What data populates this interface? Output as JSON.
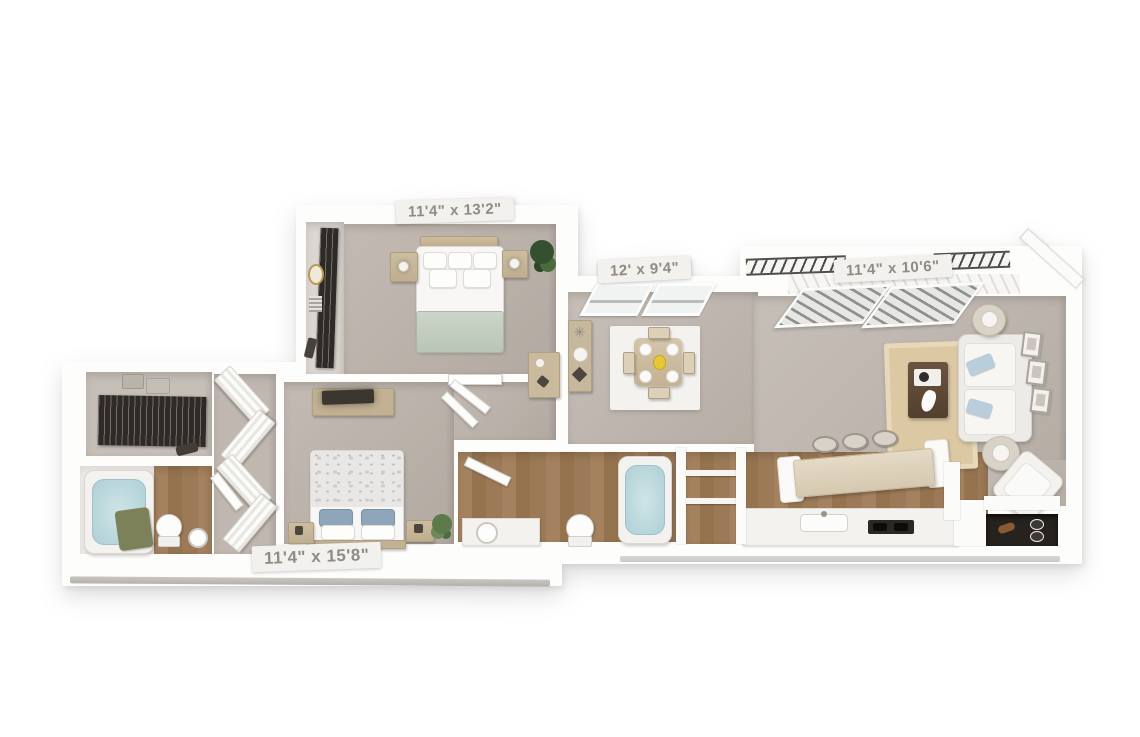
{
  "floorplan": {
    "title": "3D apartment floor plan",
    "style": "top-down 3D render, white walls on white background",
    "labels": {
      "bedroom_top": "11'4\" x 13'2\"",
      "dining": "12' x 9'4\"",
      "living": "11'4\" x 10'6\"",
      "bedroom_bottom": "11'4\" x 15'8\""
    },
    "rooms": [
      {
        "id": "bedroom-top",
        "dimensions": "11'4\" x 13'2\"",
        "floor": "gray carpet",
        "furniture": [
          "queen-bed-sage-throw",
          "headboard-shelf",
          "nightstand-left",
          "nightstand-right",
          "table-lamps",
          "wardrobe-hanging-clothes",
          "mirror",
          "corner-plant",
          "door"
        ]
      },
      {
        "id": "dining-room",
        "dimensions": "12' x 9'4\"",
        "floor": "gray carpet",
        "furniture": [
          "dining-table",
          "four-chairs",
          "place-settings",
          "yellow-centerpiece",
          "white-area-rug",
          "console-table",
          "two-windows"
        ]
      },
      {
        "id": "living-room",
        "dimensions": "11'4\" x 10'6\"",
        "floor": "gray carpet",
        "furniture": [
          "sofa-with-blue-pillows",
          "coffee-table",
          "tan-area-rug",
          "round-side-table-top",
          "round-side-table-bottom",
          "lamps",
          "three-wall-frames",
          "accent-chair",
          "balcony-railing",
          "sliding-door-blinds"
        ]
      },
      {
        "id": "bedroom-bottom",
        "dimensions": "11'4\" x 15'8\"",
        "floor": "gray carpet",
        "furniture": [
          "queen-bed-floral-duvet",
          "blue-pillows",
          "dresser-with-tv",
          "nightstand-left",
          "nightstand-right",
          "plant",
          "louvered-closet-doors"
        ]
      },
      {
        "id": "walk-in-closet",
        "floor": "gray",
        "furniture": [
          "hanging-clothes-rail",
          "storage-boxes",
          "clutch-bag"
        ]
      },
      {
        "id": "ensuite-bathroom",
        "floor": "wood",
        "furniture": [
          "bathtub",
          "olive-towel",
          "toilet",
          "sink"
        ]
      },
      {
        "id": "hall-bathroom",
        "floor": "wood",
        "furniture": [
          "vanity-sink",
          "toilet",
          "bathtub",
          "linen-closet"
        ]
      },
      {
        "id": "kitchen",
        "floor": "wood",
        "furniture": [
          "breakfast-bar",
          "three-bar-stools",
          "kitchen-sink",
          "cooktop",
          "counter",
          "pantry-nook"
        ]
      }
    ],
    "colors": {
      "background": "#ffffff",
      "walls": "#fdfdfc",
      "carpet": "#b8afa7",
      "wood_floor": "#9a7a5c",
      "closet_dark": "#2e2a26",
      "label_bg": "#f3f1ed",
      "label_text": "#8f8b85",
      "sage_throw": "#c3cec1",
      "tub_water": "#bcd9de",
      "rug_white": "#f4f2ee",
      "rug_tan": "#dcc9a4",
      "pillow_blue": "#8fa6ba",
      "furniture_tan": "#c6b89c",
      "towel_olive": "#7c8159",
      "centerpiece_yellow": "#e8c832"
    }
  }
}
